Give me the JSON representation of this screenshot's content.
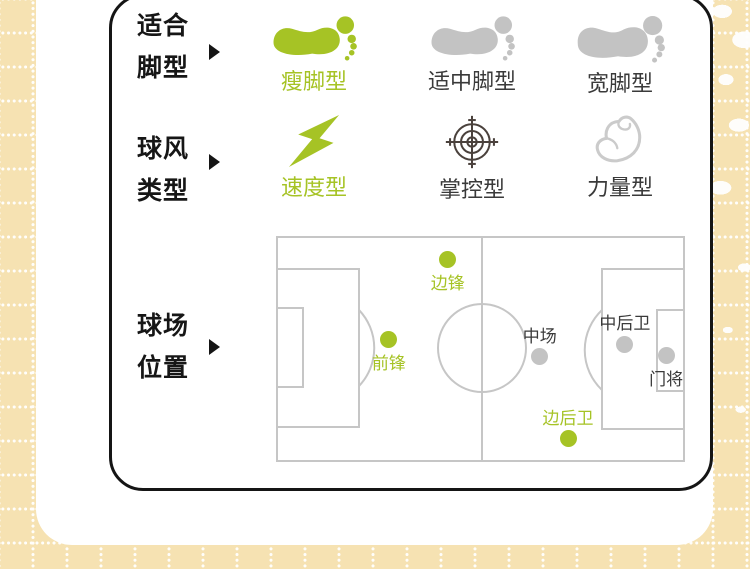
{
  "colors": {
    "accent_green": "#a6c325",
    "icon_gray": "#c3c3c3",
    "field_line": "#c6c6c6",
    "text_dark": "#3a3a3a",
    "target_icon": "#4a413c",
    "muscle_icon": "#cbcbcb",
    "tan_background": "#f6e2b2",
    "card_border": "#151515"
  },
  "rows": {
    "foot_type": {
      "label_line1": "适合",
      "label_line2": "脚型",
      "items": [
        {
          "label": "瘦脚型",
          "icon": "footprint-icon",
          "active": true
        },
        {
          "label": "适中脚型",
          "icon": "footprint-icon",
          "active": false
        },
        {
          "label": "宽脚型",
          "icon": "footprint-icon",
          "active": false
        }
      ]
    },
    "play_style": {
      "label_line1": "球风",
      "label_line2": "类型",
      "items": [
        {
          "label": "速度型",
          "icon": "lightning-icon",
          "active": true
        },
        {
          "label": "掌控型",
          "icon": "target-icon",
          "active": false
        },
        {
          "label": "力量型",
          "icon": "muscle-icon",
          "active": false
        }
      ]
    },
    "field_position": {
      "label_line1": "球场",
      "label_line2": "位置",
      "positions": [
        {
          "label": "边锋",
          "x_pct": 42.0,
          "y_pct": 10.2,
          "active": true,
          "label_side": "below"
        },
        {
          "label": "前锋",
          "x_pct": 27.6,
          "y_pct": 45.6,
          "active": true,
          "label_side": "below"
        },
        {
          "label": "中场",
          "x_pct": 64.5,
          "y_pct": 53.5,
          "active": false,
          "label_side": "above"
        },
        {
          "label": "中后卫",
          "x_pct": 85.3,
          "y_pct": 47.8,
          "active": false,
          "label_side": "above"
        },
        {
          "label": "门将",
          "x_pct": 95.4,
          "y_pct": 52.7,
          "active": false,
          "label_side": "below"
        },
        {
          "label": "边后卫",
          "x_pct": 71.4,
          "y_pct": 89.8,
          "active": true,
          "label_side": "above"
        }
      ]
    }
  }
}
